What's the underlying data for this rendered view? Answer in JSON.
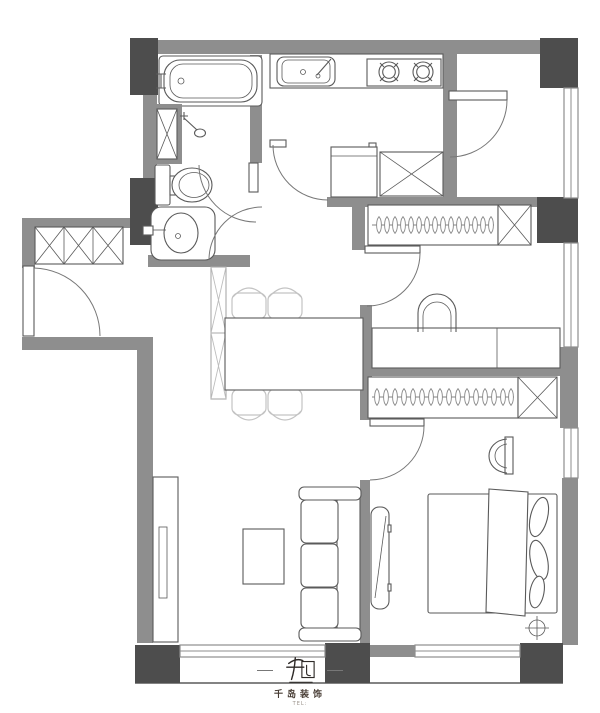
{
  "document": {
    "kind": "residential floor plan drawing",
    "orientation": "top-down"
  },
  "colors": {
    "wall": "#8e8e8e",
    "column": "#4d4d4d",
    "line": "#5a5a5a",
    "light": "#c6c6c6",
    "bg": "#ffffff"
  },
  "plan": {
    "fixtures": [
      "bathtub",
      "shower-head",
      "plumbing-shaft",
      "toilet",
      "wash-basin",
      "shoe-cabinet",
      "entry-door",
      "kitchen-sink",
      "gas-stove-2-burner",
      "refrigerator",
      "storage-cabinet-x",
      "dining-table",
      "dining-chairs-x4",
      "wardrobe-with-hangers-x2",
      "desk",
      "desk-chair",
      "double-bed",
      "pillows",
      "bedside-chair",
      "floor-drain-symbol",
      "wall-mounted-tv",
      "sofa-3-seat",
      "coffee-table",
      "tv-cabinet",
      "windows",
      "structural-columns"
    ]
  },
  "logo": {
    "mark_icon": "qiandao-seal-icon",
    "company": "千岛装饰",
    "phone": "TEL:"
  }
}
